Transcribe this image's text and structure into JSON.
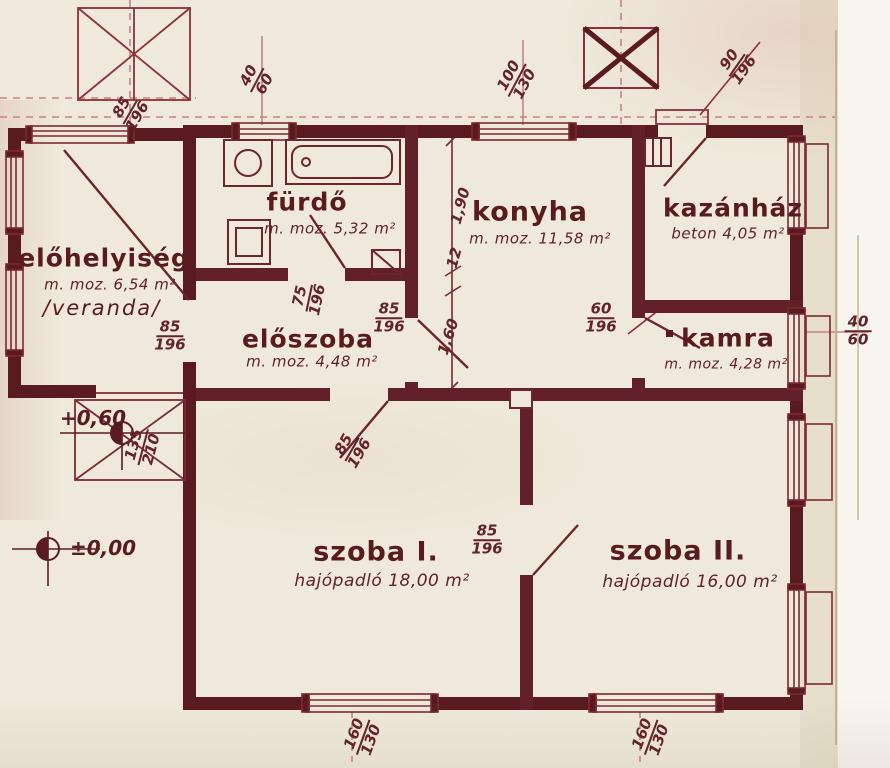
{
  "colors": {
    "ink": "#5a1a21",
    "ink_thin": "#7c2a31",
    "pink_line": "#c98086",
    "paper": "#eee9dc"
  },
  "rooms": {
    "elohelyiseg": {
      "name": "előhelyiség",
      "area": "m. moz. 6,54 m²",
      "note": "/veranda/"
    },
    "furdo": {
      "name": "fürdő",
      "area": "m. moz. 5,32 m²"
    },
    "konyha": {
      "name": "konyha",
      "area": "m. moz. 11,58 m²"
    },
    "kazanhaz": {
      "name": "kazánház",
      "area": "beton 4,05 m²"
    },
    "eloszoba": {
      "name": "előszoba",
      "area": "m. moz. 4,48 m²"
    },
    "kamra": {
      "name": "kamra",
      "area": "m. moz. 4,28 m²"
    },
    "szoba1": {
      "name": "szoba I.",
      "area": "hajópadló 18,00 m²"
    },
    "szoba2": {
      "name": "szoba II.",
      "area": "hajópadló 16,00 m²"
    }
  },
  "dims": {
    "veranda_top_window": {
      "top": "85",
      "bottom": "196"
    },
    "furdo_window": {
      "top": "40",
      "bottom": "60"
    },
    "konyha_window": {
      "top": "100",
      "bottom": "130"
    },
    "kazanhaz_door": {
      "top": "90",
      "bottom": "196"
    },
    "veranda_left_window": {
      "top": "85",
      "bottom": "196"
    },
    "furdo_door": {
      "top": "75",
      "bottom": "196"
    },
    "eloszoba_konyha_door": {
      "top": "85",
      "bottom": "196"
    },
    "kamra_door": {
      "top": "60",
      "bottom": "196"
    },
    "kamra_window": {
      "top": "40",
      "bottom": "60"
    },
    "veranda_steps": {
      "top": "135",
      "bottom": "210"
    },
    "szoba1_door": {
      "top": "85",
      "bottom": "196"
    },
    "szoba_divider_door": {
      "top": "85",
      "bottom": "196"
    },
    "szoba1_window": {
      "top": "160",
      "bottom": "130"
    },
    "szoba2_window": {
      "top": "160",
      "bottom": "130"
    },
    "konyha_wall_upper": "1,90",
    "konyha_wall_thickness": "12",
    "konyha_wall_lower": "1,60"
  },
  "levels": {
    "veranda": "+0,60",
    "ground": "±0,00"
  }
}
